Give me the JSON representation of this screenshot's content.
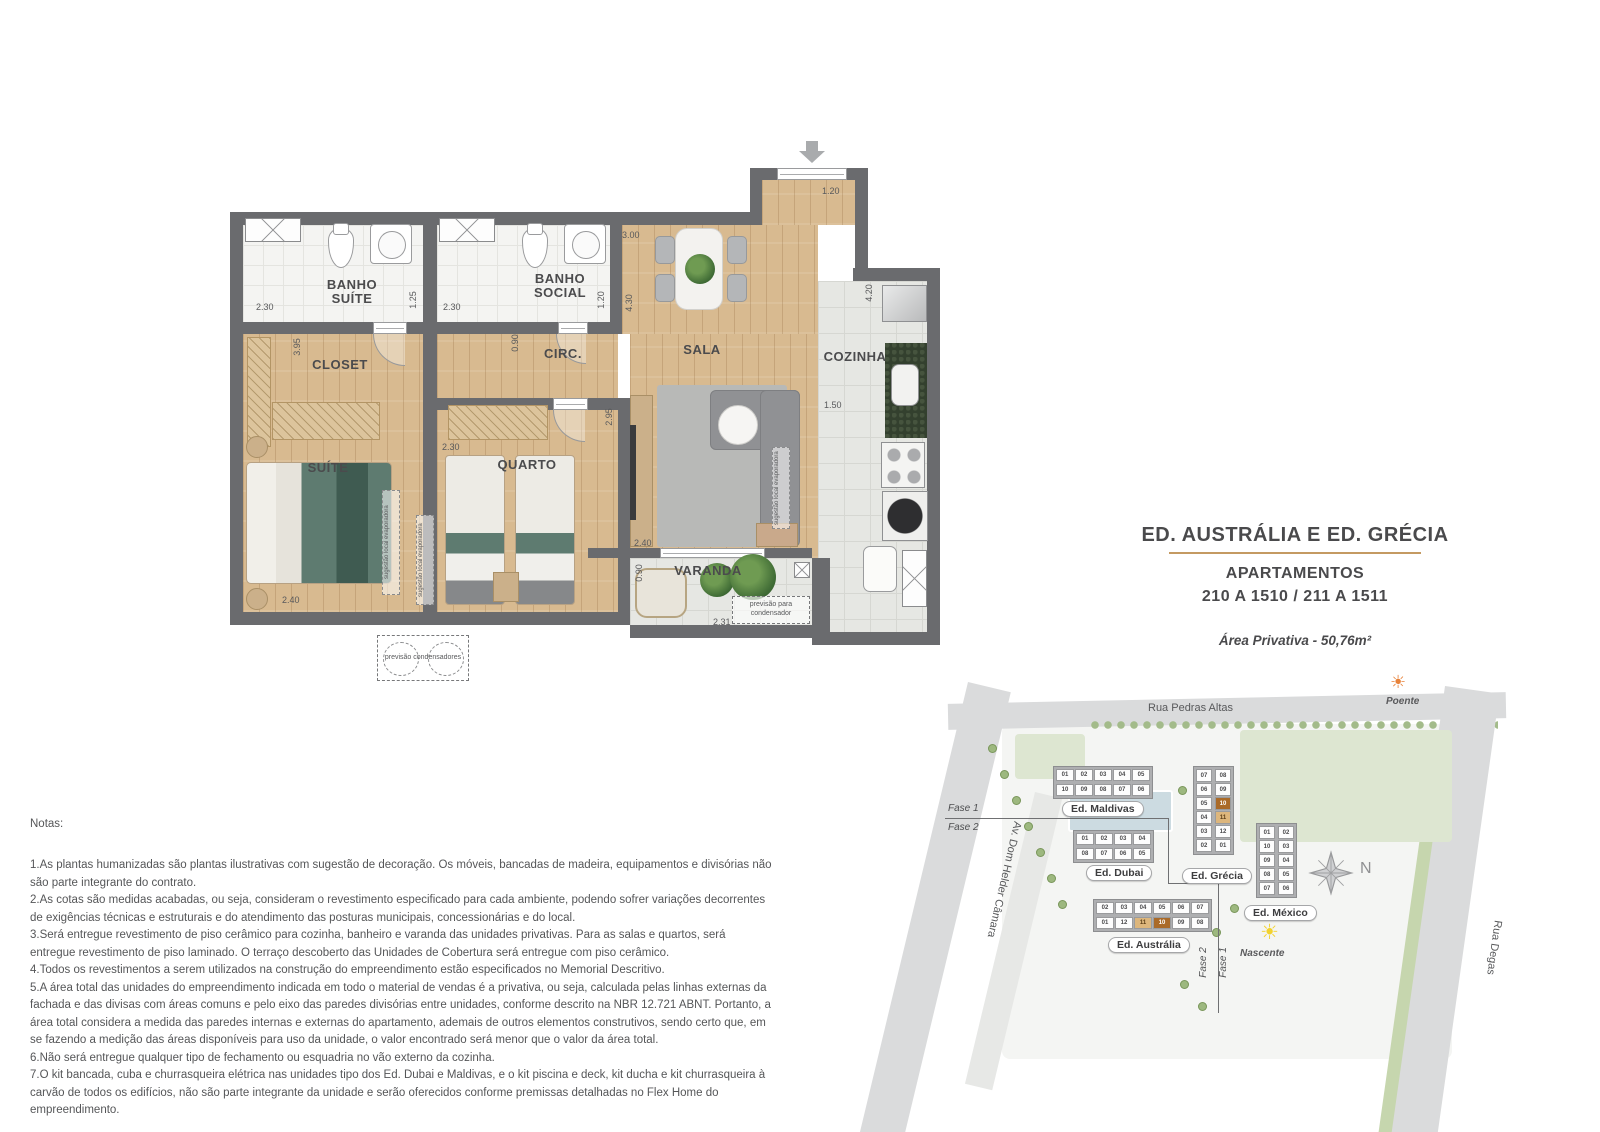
{
  "floor_plan": {
    "rooms": [
      {
        "label": "BANHO SUÍTE"
      },
      {
        "label": "BANHO SOCIAL"
      },
      {
        "label": "CLOSET"
      },
      {
        "label": "CIRC."
      },
      {
        "label": "SALA"
      },
      {
        "label": "COZINHA"
      },
      {
        "label": "SUÍTE"
      },
      {
        "label": "QUARTO"
      },
      {
        "label": "VARANDA"
      }
    ],
    "dimensions": [
      {
        "v": "1.20"
      },
      {
        "v": "3.00"
      },
      {
        "v": "4.30"
      },
      {
        "v": "2.30"
      },
      {
        "v": "1.25"
      },
      {
        "v": "2.30"
      },
      {
        "v": "1.20"
      },
      {
        "v": "3.95"
      },
      {
        "v": "0.90"
      },
      {
        "v": "4.20"
      },
      {
        "v": "1.50"
      },
      {
        "v": "2.30"
      },
      {
        "v": "2.95"
      },
      {
        "v": "2.40"
      },
      {
        "v": "2.40"
      },
      {
        "v": "0.90"
      },
      {
        "v": "2.31"
      }
    ],
    "annotations": {
      "evaporator": "sugestão local evaporadora",
      "condensers": "previsão condensadores",
      "condenser": "previsão para condensador"
    }
  },
  "title_block": {
    "line1": "ED. AUSTRÁLIA E ED. GRÉCIA",
    "line2": "APARTAMENTOS",
    "line3": "210 A 1510 / 211 A 1511",
    "area": "Área Privativa - 50,76m²",
    "underline_color": "#c49a62"
  },
  "site_map": {
    "street_top": "Rua Pedras Altas",
    "street_left": "Av. Dom Helder Câmara",
    "street_right": "Rua Degas",
    "fase1": "Fase 1",
    "fase2": "Fase 2",
    "compass": "N",
    "sun_west": "Poente",
    "sun_east": "Nascente",
    "highlight_colors": {
      "dark": "#aa6a28",
      "light": "#ddb67c"
    },
    "buildings": [
      {
        "name": "Ed. Maldivas",
        "layout": "h",
        "cells_top": [
          "01",
          "02",
          "03",
          "04",
          "05"
        ],
        "cells_bottom": [
          "10",
          "09",
          "08",
          "07",
          "06"
        ],
        "highlights": {}
      },
      {
        "name": "Ed. Dubai",
        "layout": "h",
        "cells_top": [
          "01",
          "02",
          "03",
          "04"
        ],
        "cells_bottom": [
          "08",
          "07",
          "06",
          "05"
        ],
        "highlights": {}
      },
      {
        "name": "Ed. Grécia",
        "layout": "v",
        "cells_left": [
          "07",
          "06",
          "05",
          "04",
          "03",
          "02"
        ],
        "cells_right": [
          "08",
          "09",
          "10",
          "11",
          "12",
          "01"
        ],
        "highlights": {
          "10": "dark",
          "11": "light"
        }
      },
      {
        "name": "Ed. Austrália",
        "layout": "h",
        "cells_top": [
          "02",
          "03",
          "04",
          "05",
          "06",
          "07"
        ],
        "cells_bottom": [
          "01",
          "12",
          "11",
          "10",
          "09",
          "08"
        ],
        "highlights": {
          "11": "light",
          "10": "dark"
        }
      },
      {
        "name": "Ed. México",
        "layout": "v",
        "cells_left": [
          "01",
          "10",
          "09",
          "08",
          "07"
        ],
        "cells_right": [
          "02",
          "03",
          "04",
          "05",
          "06"
        ],
        "highlights": {}
      }
    ]
  },
  "notes": {
    "heading": "Notas:",
    "items": [
      "1.As plantas humanizadas são plantas ilustrativas com sugestão de decoração. Os móveis, bancadas de madeira, equipamentos e divisórias não são parte integrante do contrato.",
      "2.As cotas são medidas acabadas, ou seja, consideram o revestimento especificado para cada ambiente, podendo sofrer variações decorrentes de exigências técnicas e estruturais e do atendimento das posturas municipais, concessionárias e do local.",
      "3.Será entregue revestimento de piso cerâmico para cozinha, banheiro e varanda das unidades privativas. Para as salas e quartos, será entregue revestimento de piso laminado. O terraço descoberto das Unidades de Cobertura será entregue com piso cerâmico.",
      "4.Todos os revestimentos a serem utilizados na construção do empreendimento estão especificados no Memorial Descritivo.",
      "5.A área total das unidades do empreendimento indicada em todo o material de vendas é a privativa, ou seja, calculada pelas linhas externas da fachada e das divisas com áreas comuns e pelo eixo das paredes divisórias entre unidades, conforme descrito na NBR 12.721 ABNT. Portanto, a área total considera a medida das paredes internas e externas do apartamento, ademais de outros elementos construtivos, sendo certo que, em se fazendo a medição das áreas disponíveis para uso da unidade, o valor encontrado será menor que o valor da área total.",
      "6.Não será entregue qualquer tipo de fechamento ou esquadria no vão externo da cozinha.",
      "7.O kit bancada, cuba e churrasqueira elétrica nas unidades tipo dos Ed. Dubai e Maldivas, e o kit piscina e deck, kit ducha e kit churrasqueira à carvão de todos os edifícios, não são parte integrante da unidade e serão oferecidos conforme premissas detalhadas no Flex Home do empreendimento."
    ],
    "footer": "A presente planta ilustra referencialmente os apartamentos 210 a 1510 dos Ed. Austrália e Ed. Grécia, sendo os apartamentos 211 a 1511 dos Ed. Austrália e Ed. Grécia espelhados."
  }
}
